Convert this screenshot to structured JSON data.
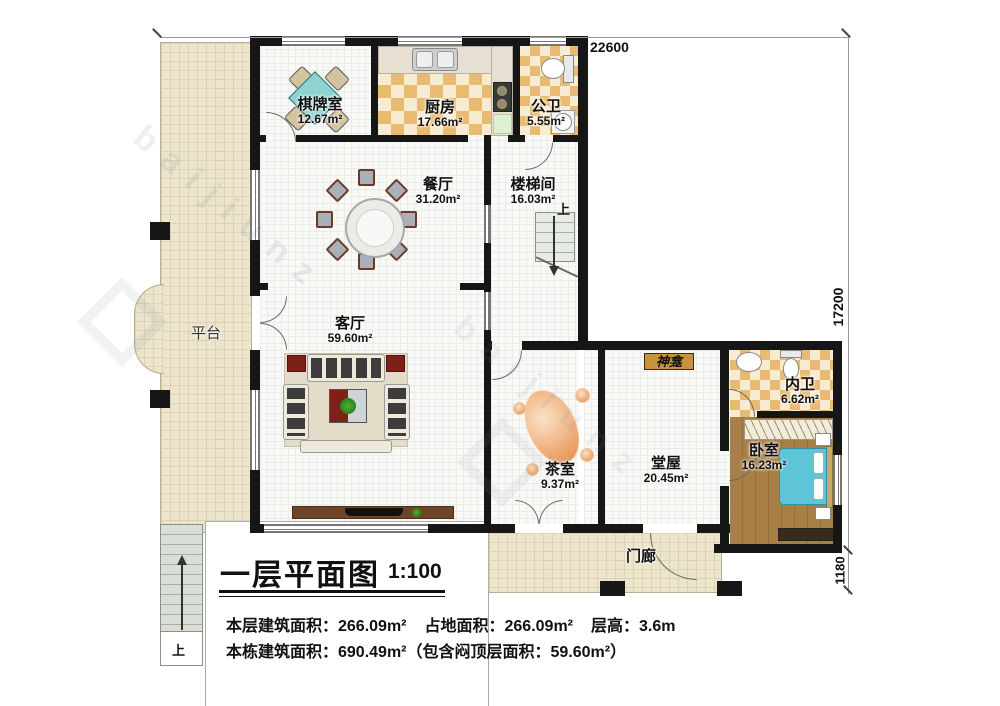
{
  "rooms": {
    "qipaishi": {
      "name": "棋牌室",
      "area": "12.67m²"
    },
    "chufang": {
      "name": "厨房",
      "area": "17.66m²"
    },
    "gongwei": {
      "name": "公卫",
      "area": "5.55m²"
    },
    "canting": {
      "name": "餐厅",
      "area": "31.20m²"
    },
    "loutijian": {
      "name": "楼梯间",
      "area": "16.03m²"
    },
    "keting": {
      "name": "客厅",
      "area": "59.60m²"
    },
    "chashi": {
      "name": "茶室",
      "area": "9.37m²"
    },
    "tangwu": {
      "name": "堂屋",
      "area": "20.45m²"
    },
    "neiwei": {
      "name": "内卫",
      "area": "6.62m²"
    },
    "woshi": {
      "name": "卧室",
      "area": "16.23m²"
    },
    "pingtai": {
      "name": "平台"
    },
    "menlang": {
      "name": "门廊"
    },
    "shenkan": {
      "name": "神龛"
    }
  },
  "annotations": {
    "up": "上"
  },
  "dimensions": {
    "top": "22600",
    "right": "17200",
    "right_lower": "1180"
  },
  "titleblock": {
    "title": "一层平面图",
    "scale": "1:100",
    "stats1_a": "本层建筑面积：266.09m²",
    "stats1_b": "占地面积：266.09m²",
    "stats1_c": "层高：3.6m",
    "stats2": "本栋建筑面积：690.49m²（包含闷顶层面积：59.60m²）"
  },
  "watermark": {
    "text": "baijiunz"
  }
}
